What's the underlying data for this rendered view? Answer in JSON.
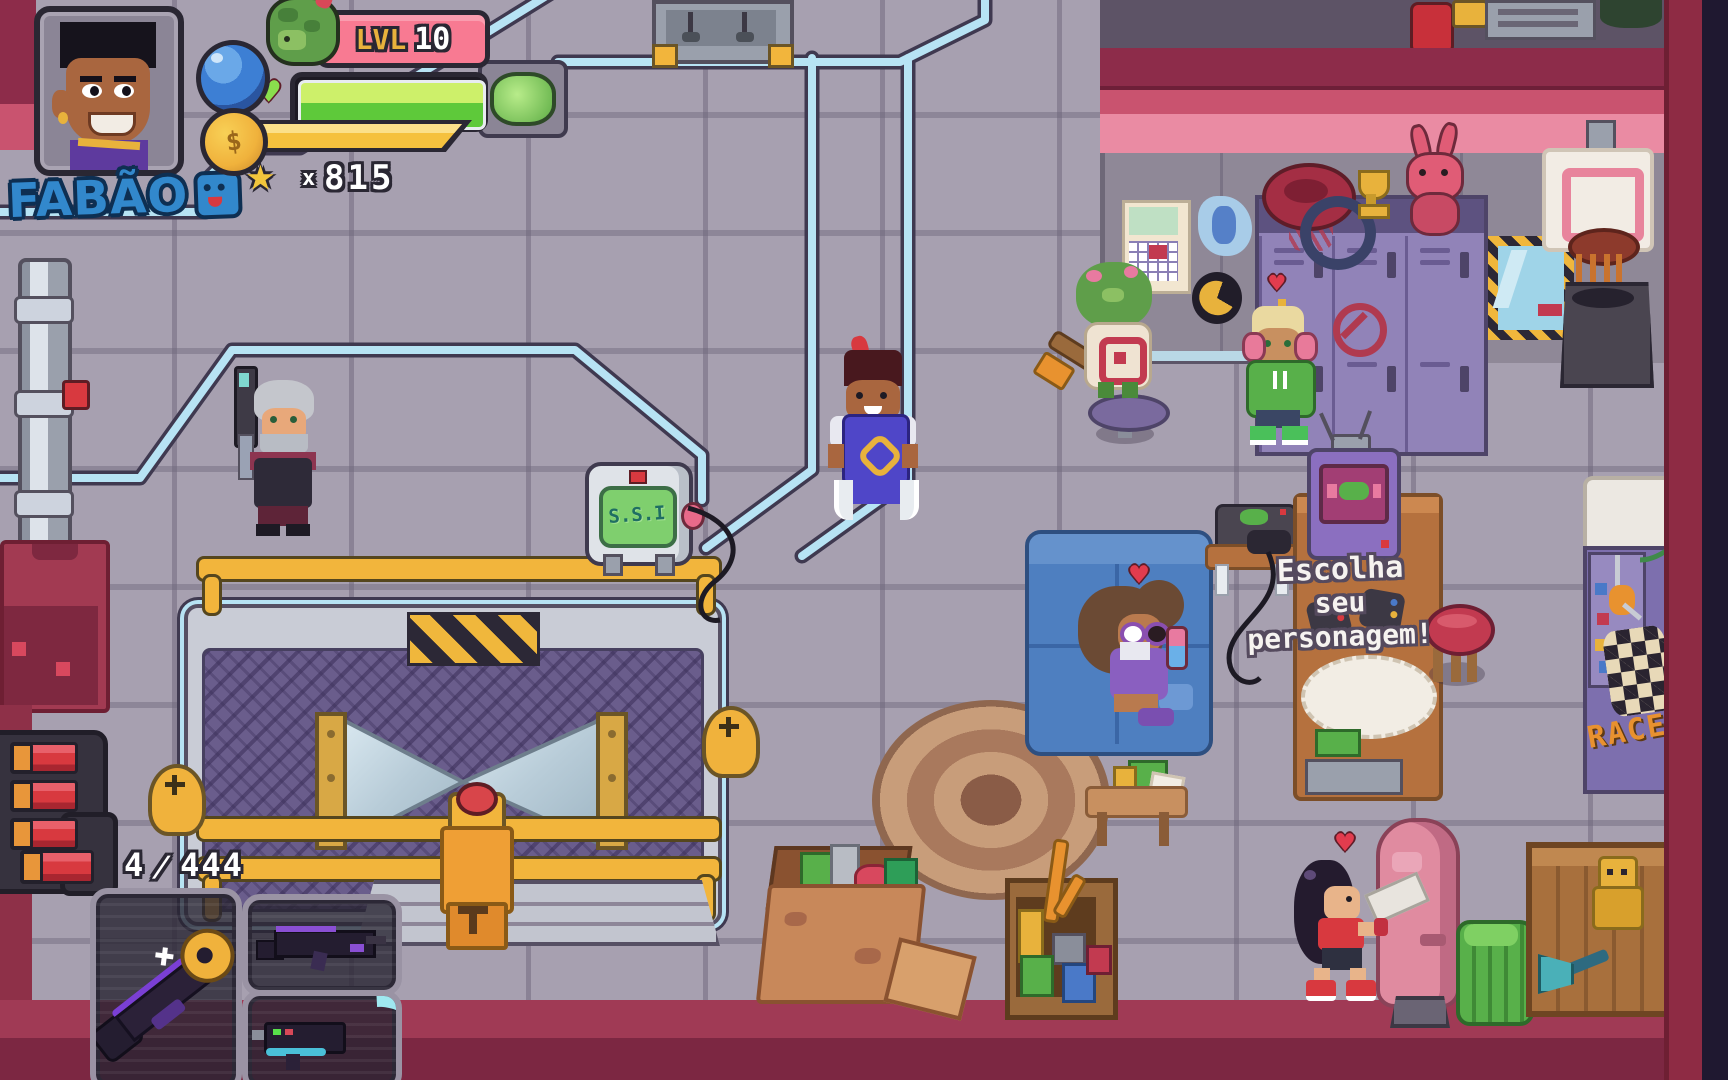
{
  "hud": {
    "player_name": "FABÃO",
    "level": {
      "label": "LVL",
      "value": "10"
    },
    "stars": {
      "prefix": "x",
      "count": "815"
    },
    "ammo": {
      "current": "4",
      "separator": "/",
      "reserve": "444"
    }
  },
  "world": {
    "ssi_screen_label": "S.S.I",
    "dialogue": {
      "line1": "Escolha",
      "line2": "seu",
      "line3": "personagem!"
    },
    "race_poster_label": "RACE"
  },
  "icons": {
    "heart": "♥",
    "star": "★",
    "coin": "$"
  },
  "colors": {
    "name_blue": "#3288cc",
    "level_badge_pink": "#f87a92",
    "level_text_gold": "#e8b23c",
    "health_green": "#5ec93a",
    "coin_bar_gold": "#f5c13e",
    "hud_outline": "#2a2733",
    "pipe_cyan": "#b7e3f4",
    "floor_gray": "#a7a0b0",
    "wall_pink": "#ea8ba3",
    "wall_maroon": "#8d2c4a",
    "locker_purple": "#9183b8",
    "mesh_purple": "#6a5d8c",
    "railing_gold": "#f2b53c",
    "couch_blue": "#4e7fc0",
    "punching_bag_pink": "#e08ba0",
    "accent_red": "#d8393f",
    "ssi_screen_green": "#a5e393",
    "race_orange": "#e8912f",
    "dialogue_white": "#f6f3f0"
  }
}
